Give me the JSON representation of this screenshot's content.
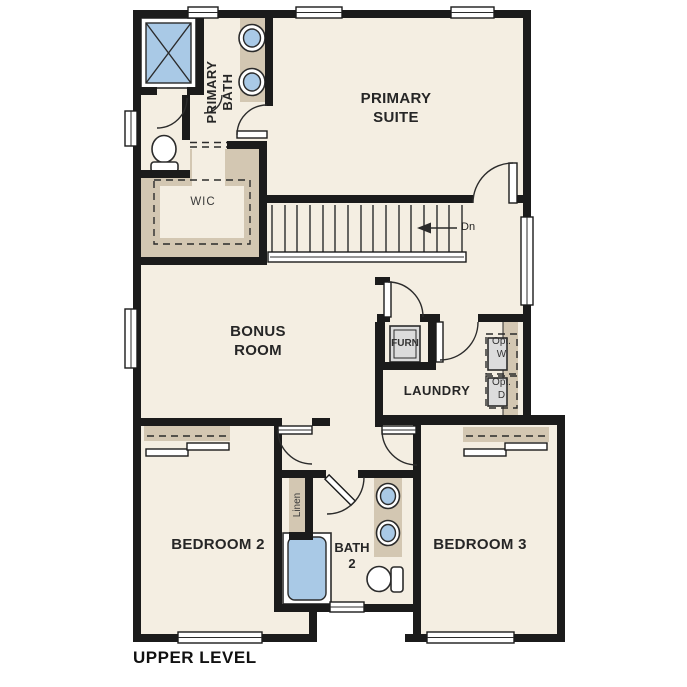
{
  "plan_title": "UPPER LEVEL",
  "colors": {
    "floor": "#f4eee2",
    "wall": "#1b1b1b",
    "tan": "#d3c7b2",
    "blue": "#a9c9e6",
    "gray": "#dcdcdc",
    "line": "#2b2b2b",
    "label": "#262626",
    "bg": "#ffffff"
  },
  "rooms": {
    "primary_bath": {
      "line1": "PRIMARY",
      "line2": "BATH"
    },
    "primary_suite": {
      "line1": "PRIMARY",
      "line2": "SUITE"
    },
    "wic": {
      "label": "WIC"
    },
    "bonus_room": {
      "line1": "BONUS",
      "line2": "ROOM"
    },
    "laundry": {
      "label": "LAUNDRY"
    },
    "furnace": {
      "label": "FURN"
    },
    "optional_washer": {
      "line1": "Opt.",
      "line2": "W"
    },
    "optional_dryer": {
      "line1": "Opt.",
      "line2": "D"
    },
    "bedroom2": {
      "label": "BEDROOM 2"
    },
    "bedroom3": {
      "label": "BEDROOM 3"
    },
    "bath2": {
      "line1": "BATH",
      "line2": "2"
    },
    "linen": {
      "label": "Linen"
    }
  },
  "stairs": {
    "direction_label": "Dn"
  },
  "fixtures": [
    "shower",
    "primary-vanity-double-sink",
    "primary-toilet",
    "walk-in-closet-rod",
    "furnace-unit",
    "optional-washer",
    "optional-dryer",
    "stairs-down",
    "stair-railing",
    "linen-closet",
    "bathtub",
    "bath2-vanity-double-sink",
    "bath2-toilet",
    "bedroom2-closet-sliding-doors",
    "bedroom3-closet-sliding-doors"
  ]
}
